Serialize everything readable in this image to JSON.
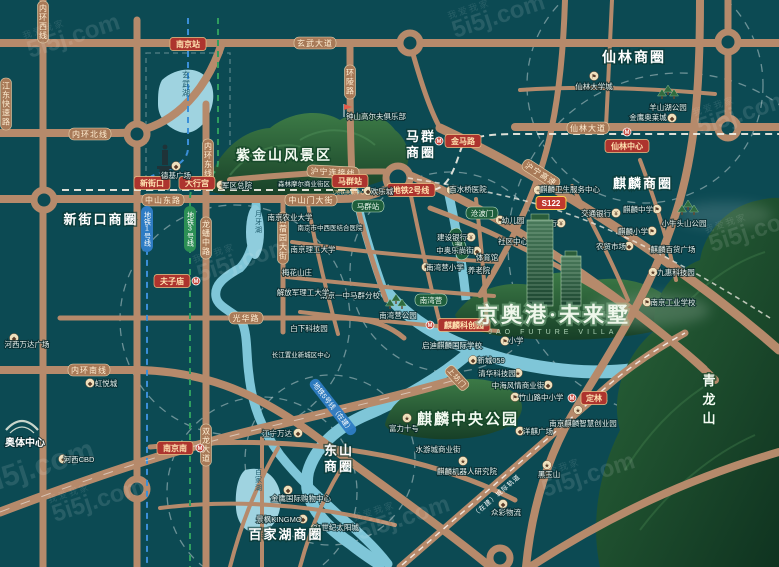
{
  "map": {
    "watermark": {
      "brand": "5i5j.com",
      "company": "我爱我家"
    },
    "property": {
      "name": "京奥港·未来墅",
      "name_en": "JAO FUTURE VILLA"
    },
    "districts": {
      "xinjiekou": "新街口商圈",
      "maqun_1": "马群",
      "maqun_2": "商圈",
      "xianlin": "仙林商圈",
      "qilin": "麒麟商圈",
      "dongshan_1": "东山",
      "dongshan_2": "商圈",
      "baijiahu": "百家湖商圈"
    },
    "areas": {
      "zijinshan": "紫金山风景区",
      "qilin_park": "麒麟中央公园",
      "qinglongshan": "青龙山",
      "aoti": "奥体中心"
    },
    "lakes": {
      "xuanwu": "玄武湖",
      "yueya": "月牙湖",
      "baijia": "百家湖"
    },
    "stations": {
      "nanjing": "南京站",
      "xinjiekou": "新街口",
      "daxinggong": "大行宫",
      "fuzimiao": "夫子庙",
      "maqun": "马群站",
      "maqun_sub": "（地铁换乘中心）",
      "jinma": "金马路",
      "xianlin_center": "仙林中心",
      "qilin_tech": "麒麟科创园",
      "dinglin": "定林",
      "nanjing_south": "南京南",
      "line2_badge": "地铁2号线",
      "s122": "S122"
    },
    "metro": {
      "line1": "地铁1号线",
      "line3": "地铁3号线",
      "line5": "地铁5号线（在建）",
      "intercity": "（在建）城际轨道"
    },
    "roads": {
      "xuanwu_ave": "玄武大道",
      "neihuan_north": "内环北线",
      "neihuan_west": "内环西线",
      "jiangdong": "江东快速路",
      "neihuan_east": "内环东线",
      "zhongshan_east": "中山东路",
      "zhongshanmen": "中山门大街",
      "huning_link": "沪宁连接线",
      "huning_expwy": "沪宁高速",
      "xianlin_ave": "仙林大道",
      "huanling": "环陵路",
      "longpan": "龙蟠中路",
      "muxuyuan": "苜蓿园大街",
      "guanghua": "光华路",
      "neihuan_south": "内环南线",
      "shuanglong": "双龙大道",
      "shangfangmen": "上坊门"
    },
    "green_labels": {
      "maqun": "马群站",
      "cangbomen": "沧波门",
      "tianquan": "天泉路",
      "nanwanying": "南湾营"
    },
    "glyphs": {
      "bank": "¥",
      "hospital": "+",
      "school": "⚑",
      "mall": "◆",
      "star": "★",
      "metro": "M"
    },
    "pois": [
      {
        "label": "德基广场"
      },
      {
        "label": "军区总院"
      },
      {
        "label": "钟山高尔夫俱乐部"
      },
      {
        "label": "仙林大学城"
      },
      {
        "label": "羊山湖公园"
      },
      {
        "label": "金鹰奥莱城"
      },
      {
        "label": "麒麟卫生服务中心"
      },
      {
        "label": "交通银行"
      },
      {
        "label": "麒麟中学"
      },
      {
        "label": "农业银行"
      },
      {
        "label": "麒麟小学"
      },
      {
        "label": "小牛头山公园"
      },
      {
        "label": "农贸市场"
      },
      {
        "label": "麒麟百货广场"
      },
      {
        "label": "九惠科技园"
      },
      {
        "label": "南京工业学校"
      },
      {
        "label": "森林摩尔商业街区"
      },
      {
        "label": "欢乐城"
      },
      {
        "label": "百水桥医院"
      },
      {
        "label": "南京农业大学"
      },
      {
        "label": "南京市中西医结合医院"
      },
      {
        "label": "幼儿园"
      },
      {
        "label": "建设银行"
      },
      {
        "label": "社区中心"
      },
      {
        "label": "中奥乐尚街"
      },
      {
        "label": "体育馆"
      },
      {
        "label": "南湾营小学"
      },
      {
        "label": "养老院"
      },
      {
        "label": "南京一中马群分校"
      },
      {
        "label": "白下科技园"
      },
      {
        "label": "长江置业新城区中心"
      },
      {
        "label": "南湾营公园"
      },
      {
        "label": "启迪麒麟国际学校"
      },
      {
        "label": "小学"
      },
      {
        "label": "新城059"
      },
      {
        "label": "清华科技园"
      },
      {
        "label": "中海风情商业街"
      },
      {
        "label": "竹山路中小学"
      },
      {
        "label": "南京麒麟智慧创业园"
      },
      {
        "label": "洋麒广场"
      },
      {
        "label": "富力十号"
      },
      {
        "label": "水游城商业街"
      },
      {
        "label": "麒麟机器人研究院"
      },
      {
        "label": "众彩物流"
      },
      {
        "label": "黑玉山"
      },
      {
        "label": "江宁万达"
      },
      {
        "label": "金鹰国际购物中心"
      },
      {
        "label": "景枫KINGMO"
      },
      {
        "label": "21世纪太阳城"
      },
      {
        "label": "河西万达广场"
      },
      {
        "label": "虹悦城"
      },
      {
        "label": "河西CBD"
      },
      {
        "label": "奥体中心"
      },
      {
        "label": "梅花山庄"
      },
      {
        "label": "南京理工大学"
      },
      {
        "label": "解放军理工大学"
      }
    ]
  }
}
